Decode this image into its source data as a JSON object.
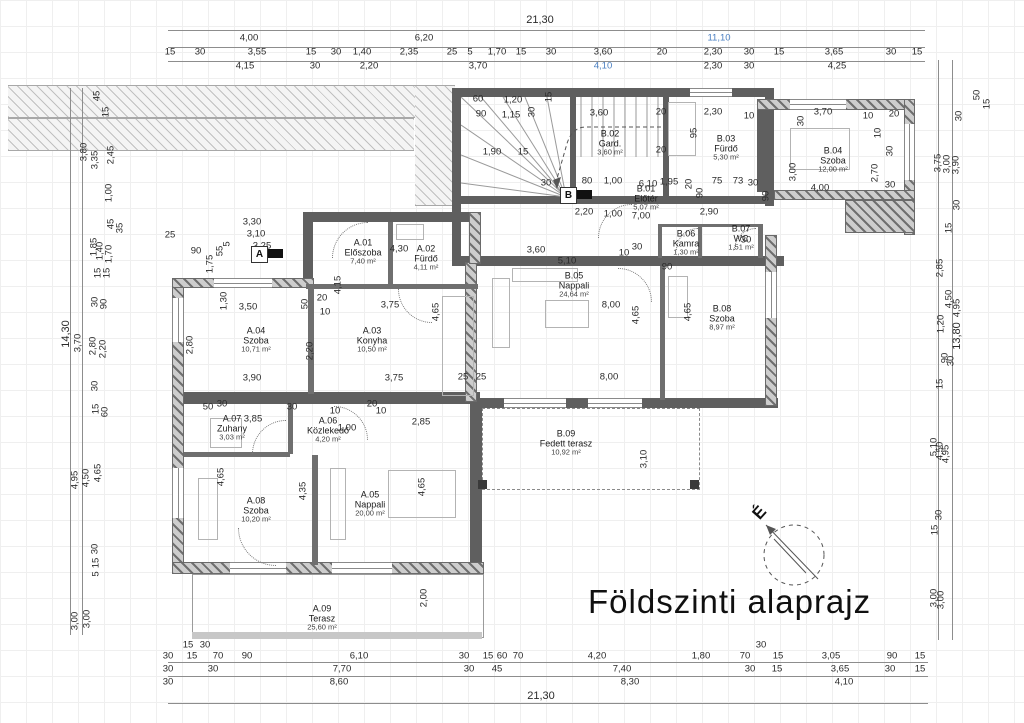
{
  "title": "Földszinti alaprajz",
  "compass": {
    "label": "É"
  },
  "markers": [
    {
      "label": "A",
      "x": 251,
      "y": 246
    },
    {
      "label": "B",
      "x": 560,
      "y": 187
    }
  ],
  "colors": {
    "wall": "#5f5f5f",
    "hatch": "#9a9a9a",
    "dim_text": "#2a2a2a",
    "accent_blue": "#4a7fc1",
    "title_text": "#101010"
  },
  "rooms": [
    {
      "code": "A.01",
      "name": "Előszoba",
      "area": "7,40 m²",
      "x": 363,
      "y": 252
    },
    {
      "code": "A.02",
      "name": "Fürdő",
      "area": "4,11 m²",
      "x": 426,
      "y": 258
    },
    {
      "code": "A.03",
      "name": "Konyha",
      "area": "10,50 m²",
      "x": 372,
      "y": 340
    },
    {
      "code": "A.04",
      "name": "Szoba",
      "area": "10,71 m²",
      "x": 256,
      "y": 340
    },
    {
      "code": "A.05",
      "name": "Nappali",
      "area": "20,00 m²",
      "x": 370,
      "y": 504
    },
    {
      "code": "A.06",
      "name": "Közlekedő",
      "area": "4,20 m²",
      "x": 328,
      "y": 430
    },
    {
      "code": "A.07",
      "name": "Zuhany",
      "area": "3,03 m²",
      "x": 232,
      "y": 428
    },
    {
      "code": "A.08",
      "name": "Szoba",
      "area": "10,20 m²",
      "x": 256,
      "y": 510
    },
    {
      "code": "A.09",
      "name": "Terasz",
      "area": "25,60 m²",
      "x": 322,
      "y": 618
    },
    {
      "code": "B.01",
      "name": "Előtér",
      "area": "5,07 m²",
      "x": 646,
      "y": 198
    },
    {
      "code": "B.02",
      "name": "Gard.",
      "area": "3,60 m²",
      "x": 610,
      "y": 143
    },
    {
      "code": "B.03",
      "name": "Fürdő",
      "area": "5,30 m²",
      "x": 726,
      "y": 148
    },
    {
      "code": "B.04",
      "name": "Szoba",
      "area": "12,00 m²",
      "x": 833,
      "y": 160
    },
    {
      "code": "B.05",
      "name": "Nappali",
      "area": "24,64 m²",
      "x": 574,
      "y": 285
    },
    {
      "code": "B.06",
      "name": "Kamra",
      "area": "1,30 m²",
      "x": 686,
      "y": 243
    },
    {
      "code": "B.07",
      "name": "WC",
      "area": "1,51 m²",
      "x": 741,
      "y": 238
    },
    {
      "code": "B.08",
      "name": "Szoba",
      "area": "8,97 m²",
      "x": 722,
      "y": 318
    },
    {
      "code": "B.09",
      "name": "Fedett terasz",
      "area": "10,92 m²",
      "x": 566,
      "y": 443
    }
  ],
  "dims": {
    "top": [
      {
        "t": "21,30",
        "x": 540,
        "y": 20,
        "b": 1
      },
      {
        "t": "4,00",
        "x": 249,
        "y": 38
      },
      {
        "t": "6,20",
        "x": 424,
        "y": 38
      },
      {
        "t": "11,10",
        "x": 719,
        "y": 38,
        "c": 1
      },
      {
        "t": "15",
        "x": 170,
        "y": 52
      },
      {
        "t": "30",
        "x": 200,
        "y": 52
      },
      {
        "t": "3,55",
        "x": 257,
        "y": 52
      },
      {
        "t": "15",
        "x": 311,
        "y": 52
      },
      {
        "t": "30",
        "x": 336,
        "y": 52
      },
      {
        "t": "1,40",
        "x": 362,
        "y": 52
      },
      {
        "t": "2,35",
        "x": 409,
        "y": 52
      },
      {
        "t": "25",
        "x": 452,
        "y": 52
      },
      {
        "t": "5",
        "x": 470,
        "y": 52
      },
      {
        "t": "1,70",
        "x": 497,
        "y": 52
      },
      {
        "t": "15",
        "x": 521,
        "y": 52
      },
      {
        "t": "30",
        "x": 551,
        "y": 52
      },
      {
        "t": "3,60",
        "x": 603,
        "y": 52
      },
      {
        "t": "20",
        "x": 662,
        "y": 52
      },
      {
        "t": "2,30",
        "x": 713,
        "y": 52
      },
      {
        "t": "30",
        "x": 749,
        "y": 52
      },
      {
        "t": "15",
        "x": 779,
        "y": 52
      },
      {
        "t": "3,65",
        "x": 834,
        "y": 52
      },
      {
        "t": "30",
        "x": 891,
        "y": 52
      },
      {
        "t": "15",
        "x": 917,
        "y": 52
      },
      {
        "t": "4,15",
        "x": 245,
        "y": 66
      },
      {
        "t": "30",
        "x": 315,
        "y": 66
      },
      {
        "t": "2,20",
        "x": 369,
        "y": 66
      },
      {
        "t": "3,70",
        "x": 478,
        "y": 66
      },
      {
        "t": "4,10",
        "x": 603,
        "y": 66,
        "c": 1
      },
      {
        "t": "2,30",
        "x": 713,
        "y": 66
      },
      {
        "t": "30",
        "x": 749,
        "y": 66
      },
      {
        "t": "4,25",
        "x": 837,
        "y": 66
      }
    ],
    "bottom": [
      {
        "t": "15",
        "x": 188,
        "y": 645
      },
      {
        "t": "30",
        "x": 205,
        "y": 645
      },
      {
        "t": "30",
        "x": 761,
        "y": 645
      },
      {
        "t": "30",
        "x": 168,
        "y": 656
      },
      {
        "t": "15",
        "x": 192,
        "y": 656
      },
      {
        "t": "70",
        "x": 218,
        "y": 656
      },
      {
        "t": "90",
        "x": 247,
        "y": 656
      },
      {
        "t": "6,10",
        "x": 359,
        "y": 656
      },
      {
        "t": "30",
        "x": 464,
        "y": 656
      },
      {
        "t": "15",
        "x": 488,
        "y": 656
      },
      {
        "t": "60",
        "x": 502,
        "y": 656
      },
      {
        "t": "70",
        "x": 518,
        "y": 656
      },
      {
        "t": "4,20",
        "x": 597,
        "y": 656
      },
      {
        "t": "1,80",
        "x": 701,
        "y": 656
      },
      {
        "t": "70",
        "x": 745,
        "y": 656
      },
      {
        "t": "15",
        "x": 778,
        "y": 656
      },
      {
        "t": "3,05",
        "x": 831,
        "y": 656
      },
      {
        "t": "90",
        "x": 892,
        "y": 656
      },
      {
        "t": "15",
        "x": 920,
        "y": 656
      },
      {
        "t": "30",
        "x": 168,
        "y": 669
      },
      {
        "t": "30",
        "x": 213,
        "y": 669
      },
      {
        "t": "7,70",
        "x": 342,
        "y": 669
      },
      {
        "t": "30",
        "x": 469,
        "y": 669
      },
      {
        "t": "45",
        "x": 497,
        "y": 669
      },
      {
        "t": "7,40",
        "x": 622,
        "y": 669
      },
      {
        "t": "30",
        "x": 750,
        "y": 669
      },
      {
        "t": "15",
        "x": 777,
        "y": 669
      },
      {
        "t": "3,65",
        "x": 840,
        "y": 669
      },
      {
        "t": "30",
        "x": 890,
        "y": 669
      },
      {
        "t": "15",
        "x": 920,
        "y": 669
      },
      {
        "t": "30",
        "x": 168,
        "y": 682
      },
      {
        "t": "8,60",
        "x": 339,
        "y": 682
      },
      {
        "t": "8,30",
        "x": 630,
        "y": 682
      },
      {
        "t": "4,10",
        "x": 844,
        "y": 682
      },
      {
        "t": "21,30",
        "x": 541,
        "y": 696,
        "b": 1
      }
    ],
    "left": [
      {
        "t": "45",
        "x": 97,
        "y": 96,
        "r": 1
      },
      {
        "t": "15",
        "x": 106,
        "y": 112,
        "r": 1
      },
      {
        "t": "2,45",
        "x": 111,
        "y": 155,
        "r": 1
      },
      {
        "t": "3,80",
        "x": 84,
        "y": 152,
        "r": 1
      },
      {
        "t": "3,35",
        "x": 95,
        "y": 160,
        "r": 1
      },
      {
        "t": "1,00",
        "x": 109,
        "y": 193,
        "r": 1
      },
      {
        "t": "45",
        "x": 111,
        "y": 224,
        "r": 1
      },
      {
        "t": "35",
        "x": 120,
        "y": 228,
        "r": 1
      },
      {
        "t": "1,85",
        "x": 94,
        "y": 247,
        "r": 1
      },
      {
        "t": "1,40",
        "x": 100,
        "y": 251,
        "r": 1
      },
      {
        "t": "1,70",
        "x": 109,
        "y": 254,
        "r": 1
      },
      {
        "t": "15",
        "x": 98,
        "y": 273,
        "r": 1
      },
      {
        "t": "15",
        "x": 107,
        "y": 273,
        "r": 1
      },
      {
        "t": "30",
        "x": 95,
        "y": 302,
        "r": 1
      },
      {
        "t": "90",
        "x": 104,
        "y": 304,
        "r": 1
      },
      {
        "t": "14,30",
        "x": 66,
        "y": 334,
        "r": 1,
        "b": 1
      },
      {
        "t": "3,70",
        "x": 78,
        "y": 343,
        "r": 1
      },
      {
        "t": "2,80",
        "x": 93,
        "y": 346,
        "r": 1
      },
      {
        "t": "2,20",
        "x": 103,
        "y": 349,
        "r": 1
      },
      {
        "t": "30",
        "x": 95,
        "y": 386,
        "r": 1
      },
      {
        "t": "15",
        "x": 96,
        "y": 409,
        "r": 1
      },
      {
        "t": "60",
        "x": 105,
        "y": 412,
        "r": 1
      },
      {
        "t": "4,95",
        "x": 75,
        "y": 480,
        "r": 1
      },
      {
        "t": "4,50",
        "x": 86,
        "y": 478,
        "r": 1
      },
      {
        "t": "4,65",
        "x": 98,
        "y": 473,
        "r": 1
      },
      {
        "t": "30",
        "x": 95,
        "y": 549,
        "r": 1
      },
      {
        "t": "15",
        "x": 96,
        "y": 563,
        "r": 1
      },
      {
        "t": "5",
        "x": 96,
        "y": 574,
        "r": 1
      },
      {
        "t": "3,00",
        "x": 75,
        "y": 621,
        "r": 1
      },
      {
        "t": "3,00",
        "x": 87,
        "y": 619,
        "r": 1
      }
    ],
    "right": [
      {
        "t": "50",
        "x": 977,
        "y": 95,
        "r": 1
      },
      {
        "t": "15",
        "x": 987,
        "y": 104,
        "r": 1
      },
      {
        "t": "30",
        "x": 959,
        "y": 116,
        "r": 1
      },
      {
        "t": "3,75",
        "x": 938,
        "y": 163,
        "r": 1
      },
      {
        "t": "3,00",
        "x": 947,
        "y": 164,
        "r": 1
      },
      {
        "t": "3,90",
        "x": 956,
        "y": 165,
        "r": 1
      },
      {
        "t": "30",
        "x": 957,
        "y": 205,
        "r": 1
      },
      {
        "t": "15",
        "x": 949,
        "y": 228,
        "r": 1
      },
      {
        "t": "2,85",
        "x": 940,
        "y": 268,
        "r": 1
      },
      {
        "t": "4,50",
        "x": 949,
        "y": 299,
        "r": 1
      },
      {
        "t": "4,95",
        "x": 957,
        "y": 308,
        "r": 1
      },
      {
        "t": "1,20",
        "x": 941,
        "y": 324,
        "r": 1
      },
      {
        "t": "13,80",
        "x": 957,
        "y": 336,
        "r": 1,
        "b": 1
      },
      {
        "t": "90",
        "x": 945,
        "y": 358,
        "r": 1
      },
      {
        "t": "30",
        "x": 951,
        "y": 361,
        "r": 1
      },
      {
        "t": "15",
        "x": 940,
        "y": 384,
        "r": 1
      },
      {
        "t": "5,10",
        "x": 934,
        "y": 447,
        "r": 1
      },
      {
        "t": "4,50",
        "x": 940,
        "y": 451,
        "r": 1
      },
      {
        "t": "4,95",
        "x": 946,
        "y": 454,
        "r": 1
      },
      {
        "t": "30",
        "x": 939,
        "y": 515,
        "r": 1
      },
      {
        "t": "15",
        "x": 935,
        "y": 530,
        "r": 1
      },
      {
        "t": "3,00",
        "x": 934,
        "y": 598,
        "r": 1
      },
      {
        "t": "3,00",
        "x": 941,
        "y": 600,
        "r": 1
      }
    ],
    "inner": [
      {
        "t": "60",
        "x": 478,
        "y": 99
      },
      {
        "t": "1,20",
        "x": 513,
        "y": 100
      },
      {
        "t": "90",
        "x": 481,
        "y": 114
      },
      {
        "t": "1,15",
        "x": 511,
        "y": 115
      },
      {
        "t": "30",
        "x": 532,
        "y": 112,
        "r": 1
      },
      {
        "t": "15",
        "x": 549,
        "y": 97,
        "r": 1
      },
      {
        "t": "3,60",
        "x": 599,
        "y": 113
      },
      {
        "t": "20",
        "x": 661,
        "y": 112
      },
      {
        "t": "20",
        "x": 661,
        "y": 150
      },
      {
        "t": "2,30",
        "x": 713,
        "y": 112
      },
      {
        "t": "10",
        "x": 749,
        "y": 116
      },
      {
        "t": "95",
        "x": 694,
        "y": 133,
        "r": 1
      },
      {
        "t": "3,70",
        "x": 823,
        "y": 112
      },
      {
        "t": "10",
        "x": 868,
        "y": 116
      },
      {
        "t": "20",
        "x": 894,
        "y": 114
      },
      {
        "t": "30",
        "x": 801,
        "y": 121,
        "r": 1
      },
      {
        "t": "10",
        "x": 878,
        "y": 133,
        "r": 1
      },
      {
        "t": "30",
        "x": 890,
        "y": 151,
        "r": 1
      },
      {
        "t": "3,00",
        "x": 793,
        "y": 172,
        "r": 1
      },
      {
        "t": "4,00",
        "x": 820,
        "y": 188
      },
      {
        "t": "2,70",
        "x": 875,
        "y": 173,
        "r": 1
      },
      {
        "t": "30",
        "x": 890,
        "y": 185
      },
      {
        "t": "90",
        "x": 766,
        "y": 196,
        "r": 1
      },
      {
        "t": "1,90",
        "x": 492,
        "y": 152
      },
      {
        "t": "15",
        "x": 523,
        "y": 152
      },
      {
        "t": "30",
        "x": 546,
        "y": 183
      },
      {
        "t": "80",
        "x": 587,
        "y": 181
      },
      {
        "t": "1,00",
        "x": 613,
        "y": 181
      },
      {
        "t": "6,10",
        "x": 648,
        "y": 184
      },
      {
        "t": "1,95",
        "x": 669,
        "y": 182
      },
      {
        "t": "20",
        "x": 689,
        "y": 184,
        "r": 1
      },
      {
        "t": "75",
        "x": 717,
        "y": 181
      },
      {
        "t": "73",
        "x": 738,
        "y": 181
      },
      {
        "t": "30",
        "x": 753,
        "y": 183
      },
      {
        "t": "2,20",
        "x": 584,
        "y": 212
      },
      {
        "t": "1,00",
        "x": 613,
        "y": 214
      },
      {
        "t": "7,00",
        "x": 641,
        "y": 216
      },
      {
        "t": "2,90",
        "x": 709,
        "y": 212
      },
      {
        "t": "90",
        "x": 700,
        "y": 193,
        "r": 1
      },
      {
        "t": "3,60",
        "x": 536,
        "y": 250
      },
      {
        "t": "5,10",
        "x": 567,
        "y": 261
      },
      {
        "t": "10",
        "x": 624,
        "y": 253
      },
      {
        "t": "30",
        "x": 637,
        "y": 247
      },
      {
        "t": "90",
        "x": 667,
        "y": 267
      },
      {
        "t": "30",
        "x": 746,
        "y": 240
      },
      {
        "t": "3,30",
        "x": 252,
        "y": 222
      },
      {
        "t": "3,10",
        "x": 256,
        "y": 234
      },
      {
        "t": "3,25",
        "x": 262,
        "y": 246
      },
      {
        "t": "25",
        "x": 170,
        "y": 235
      },
      {
        "t": "90",
        "x": 196,
        "y": 251
      },
      {
        "t": "1,75",
        "x": 210,
        "y": 264,
        "r": 1
      },
      {
        "t": "55",
        "x": 220,
        "y": 251,
        "r": 1
      },
      {
        "t": "5",
        "x": 227,
        "y": 244,
        "r": 1
      },
      {
        "t": "20",
        "x": 322,
        "y": 298
      },
      {
        "t": "10",
        "x": 325,
        "y": 312
      },
      {
        "t": "50",
        "x": 305,
        "y": 304,
        "r": 1
      },
      {
        "t": "1,30",
        "x": 224,
        "y": 301,
        "r": 1
      },
      {
        "t": "3,50",
        "x": 248,
        "y": 307
      },
      {
        "t": "2,80",
        "x": 190,
        "y": 345,
        "r": 1
      },
      {
        "t": "3,90",
        "x": 252,
        "y": 378
      },
      {
        "t": "2,20",
        "x": 310,
        "y": 351,
        "r": 1
      },
      {
        "t": "4,30",
        "x": 399,
        "y": 249
      },
      {
        "t": "3,75",
        "x": 390,
        "y": 305
      },
      {
        "t": "4,65",
        "x": 436,
        "y": 312,
        "r": 1
      },
      {
        "t": "4,15",
        "x": 338,
        "y": 285,
        "r": 1
      },
      {
        "t": "3,75",
        "x": 394,
        "y": 378
      },
      {
        "t": "25",
        "x": 463,
        "y": 377
      },
      {
        "t": "25",
        "x": 481,
        "y": 377
      },
      {
        "t": "8,00",
        "x": 611,
        "y": 305
      },
      {
        "t": "8,00",
        "x": 609,
        "y": 377
      },
      {
        "t": "4,65",
        "x": 636,
        "y": 315,
        "r": 1
      },
      {
        "t": "4,65",
        "x": 688,
        "y": 312,
        "r": 1
      },
      {
        "t": "50",
        "x": 208,
        "y": 407
      },
      {
        "t": "30",
        "x": 222,
        "y": 404
      },
      {
        "t": "3,85",
        "x": 253,
        "y": 419
      },
      {
        "t": "30",
        "x": 292,
        "y": 407
      },
      {
        "t": "10",
        "x": 335,
        "y": 411
      },
      {
        "t": "20",
        "x": 372,
        "y": 404
      },
      {
        "t": "10",
        "x": 381,
        "y": 411
      },
      {
        "t": "1,00",
        "x": 347,
        "y": 428
      },
      {
        "t": "2,85",
        "x": 421,
        "y": 422
      },
      {
        "t": "4,65",
        "x": 221,
        "y": 477,
        "r": 1
      },
      {
        "t": "4,35",
        "x": 303,
        "y": 491,
        "r": 1
      },
      {
        "t": "4,65",
        "x": 422,
        "y": 487,
        "r": 1
      },
      {
        "t": "3,10",
        "x": 644,
        "y": 459,
        "r": 1
      },
      {
        "t": "2,00",
        "x": 424,
        "y": 598,
        "r": 1
      }
    ]
  }
}
